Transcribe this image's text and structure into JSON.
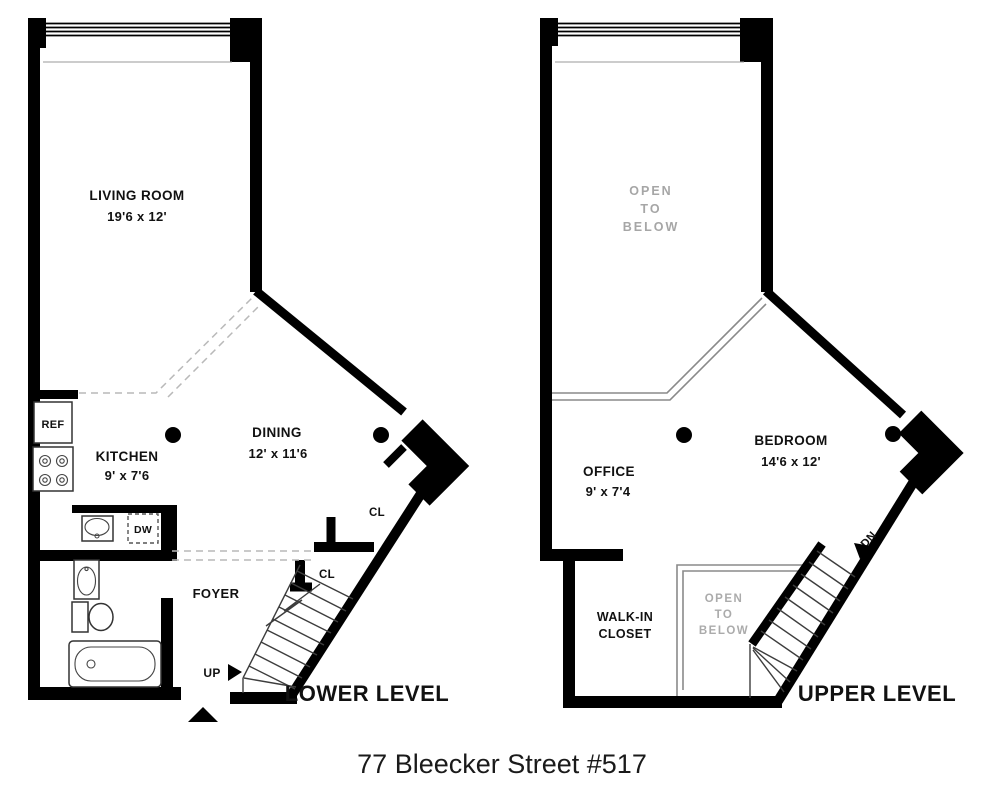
{
  "title": "77 Bleecker Street #517",
  "colors": {
    "wall": "#000000",
    "muted_text": "#a6a6a6",
    "dashed_line": "#b9b9b9",
    "background": "#ffffff"
  },
  "lower": {
    "name": "LOWER LEVEL",
    "living_room": {
      "label": "LIVING ROOM",
      "dims": "19'6 x 12'"
    },
    "kitchen": {
      "label": "KITCHEN",
      "dims": "9' x 7'6"
    },
    "dining": {
      "label": "DINING",
      "dims": "12' x 11'6"
    },
    "foyer_label": "FOYER",
    "closet1_label": "CL",
    "closet2_label": "CL",
    "refrigerator_label": "REF",
    "dishwasher_label": "DW",
    "stairs_label": "UP"
  },
  "upper": {
    "name": "UPPER LEVEL",
    "office": {
      "label": "OFFICE",
      "dims": "9' x 7'4"
    },
    "bedroom": {
      "label": "BEDROOM",
      "dims": "14'6 x 12'"
    },
    "walk_in_closet": {
      "line1": "WALK-IN",
      "line2": "CLOSET"
    },
    "open_to_below_main": {
      "line1": "OPEN",
      "line2": "TO",
      "line3": "BELOW"
    },
    "open_to_below_stairs": {
      "line1": "OPEN",
      "line2": "TO",
      "line3": "BELOW"
    },
    "stairs_label": "DN"
  }
}
